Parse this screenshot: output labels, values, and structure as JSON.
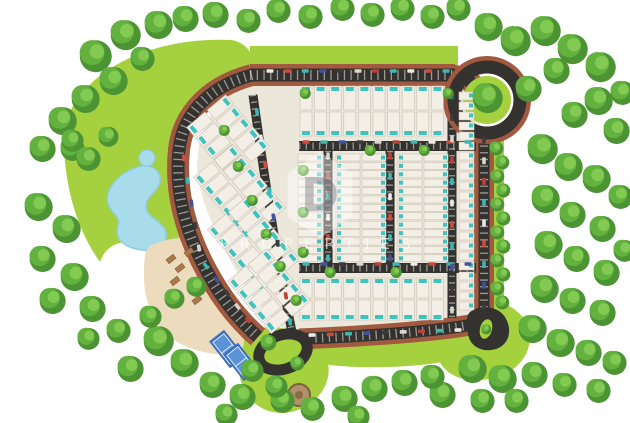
{
  "watermark": {
    "logo_letter": "D",
    "text": "PROPERTIES"
  },
  "palette": {
    "bg": "#ffffff",
    "lawn": "#a6d13e",
    "pad": "#ece7db",
    "sand": "#ecdcbd",
    "water": "#a9dcea",
    "waterEdge": "#90ccdd",
    "asphalt": "#34322e",
    "paver": "#a1593f",
    "tick": "rgba(255,255,255,0.5)",
    "house": "#f4efe6",
    "houseEdge": "#c8c0b2",
    "pool": "#3fc3bf",
    "treeBase": "#4c9333",
    "treeMid": "#63b13f",
    "treeHi": "#83ca52",
    "court": "#3a6fc2",
    "courtIn": "#5b93d8",
    "cabana": "#a97a4c",
    "gazebo": "#b2906a",
    "gazeboEdge": "#7c5f40",
    "cars": [
      "#eceae6",
      "#cf4b3b",
      "#3eb7b2",
      "#42549e",
      "#3b3b3b",
      "#d8d6d2",
      "#b8413a",
      "#3eb7b2"
    ]
  },
  "scene": {
    "lawns": [
      "M64,128 C78,72 150,36 232,40 C250,44 256,58 250,72 C212,84 192,108 184,142 C176,174 184,214 198,252 C186,260 166,256 150,248 C128,238 108,240 100,262 C78,232 62,184 64,128 Z",
      "M250,46 L458,46 L458,66 L250,66 Z",
      "M492,134 L504,134 L504,314 L492,314 Z",
      "M438,300 C468,292 504,298 520,314 C536,330 532,356 512,370 C490,384 458,384 444,368 C430,352 428,312 438,300 Z",
      "M298,336 C350,344 420,340 470,330 L470,356 C430,368 350,372 300,360 Z",
      "M248,330 C280,322 312,332 324,352 C336,374 324,400 298,410 C270,420 246,404 240,378 C236,358 238,338 248,330 Z"
    ],
    "pad": "M258,78 L452,78 C468,80 478,92 480,106 L480,316 C480,326 474,332 464,330 L302,338 C282,332 262,312 243,282 C222,248 204,212 198,178 C194,148 204,116 228,96 C238,87 248,80 258,78 Z",
    "lake": "M135,168 C150,162 162,170 160,182 C158,192 146,196 146,206 C146,218 162,220 166,232 C168,244 156,252 142,250 C124,248 114,238 118,226 C121,217 112,214 108,204 C104,190 118,174 135,168 Z",
    "pond": {
      "cx": 147,
      "cy": 158,
      "r": 8
    },
    "sand": "M150,246 C166,238 188,234 198,244 C210,260 224,288 236,314 C244,334 248,348 238,352 C220,358 194,352 174,340 C156,328 144,302 144,278 C144,260 144,252 150,246 Z",
    "roads": [
      {
        "d": "M250,75 L455,75",
        "w": 13,
        "paver": true,
        "ticks": true
      },
      {
        "d": "M452,75 C468,77 479,87 483,99",
        "w": 12,
        "paver": true,
        "ticks": false
      },
      {
        "d": "M484,132 L484,314",
        "w": 11,
        "paver": true,
        "ticks": true
      },
      {
        "d": "M470,325 C430,332 368,336 299,339",
        "w": 12,
        "paver": true,
        "ticks": true
      },
      {
        "d": "M252,75 C203,88 182,120 179,150 C175,188 184,226 202,262 C216,290 235,317 258,337",
        "w": 13,
        "paver": true,
        "ticks": true
      },
      {
        "d": "M253,95 C262,160 274,244 292,332",
        "w": 9,
        "paver": false,
        "ticks": true
      },
      {
        "d": "M299,146 L476,146",
        "w": 10,
        "paver": false,
        "ticks": true
      },
      {
        "d": "M299,268 L476,268",
        "w": 10,
        "paver": false,
        "ticks": true
      },
      {
        "d": "M328,151 L328,263",
        "w": 9,
        "paver": false,
        "ticks": true
      },
      {
        "d": "M390,151 L390,263",
        "w": 9,
        "paver": false,
        "ticks": true
      },
      {
        "d": "M452,88 L452,318",
        "w": 9,
        "paver": false,
        "ticks": true
      }
    ],
    "roundabout": {
      "cx": 487,
      "cy": 100,
      "rPaver": 40,
      "rRoad": 33,
      "rGreen": 24,
      "treeR": 15
    },
    "teardrop": {
      "d": "M470,312 C480,304 498,306 505,317 C513,330 509,345 496,349 C483,353 470,347 468,334 C467,326 465,317 470,312 Z",
      "island": {
        "cx": 486,
        "cy": 329,
        "rx": 6,
        "ry": 10,
        "rot": 15,
        "treeR": 5
      }
    },
    "loop": {
      "cx": 283,
      "cy": 352,
      "rx": 25,
      "ry": 17,
      "rot": -20,
      "w": 11,
      "islandRx": 13,
      "islandRy": 7
    },
    "bandsVertical": [
      {
        "x": 300,
        "y": 86,
        "n": 10,
        "pitch": 14.6,
        "w": 12,
        "h": 24,
        "pool": "top"
      },
      {
        "x": 300,
        "y": 112,
        "n": 10,
        "pitch": 14.6,
        "w": 12,
        "h": 24,
        "pool": "bottom"
      },
      {
        "x": 300,
        "y": 278,
        "n": 10,
        "pitch": 14.6,
        "w": 12,
        "h": 20,
        "pool": "top"
      },
      {
        "x": 300,
        "y": 300,
        "n": 10,
        "pitch": 14.6,
        "w": 12,
        "h": 20,
        "pool": "bottom"
      }
    ],
    "columnsHorizontal": [
      {
        "x": 298,
        "y": 154,
        "n": 13,
        "pitch": 8.4,
        "w": 24,
        "h": 7,
        "pool": "right"
      },
      {
        "x": 336,
        "y": 154,
        "n": 13,
        "pitch": 8.4,
        "w": 24,
        "h": 7,
        "pool": "left"
      },
      {
        "x": 362,
        "y": 154,
        "n": 13,
        "pitch": 8.4,
        "w": 24,
        "h": 7,
        "pool": "right"
      },
      {
        "x": 398,
        "y": 154,
        "n": 13,
        "pitch": 8.4,
        "w": 24,
        "h": 7,
        "pool": "left"
      },
      {
        "x": 424,
        "y": 154,
        "n": 13,
        "pitch": 8.4,
        "w": 24,
        "h": 7,
        "pool": "right"
      },
      {
        "x": 459,
        "y": 92,
        "n": 22,
        "pitch": 10,
        "w": 15,
        "h": 8,
        "pool": "right"
      }
    ],
    "angledStrips": [
      {
        "x": 205,
        "y": 112,
        "angle": 50,
        "n": 5,
        "pitch": 14,
        "w": 12,
        "h": 24,
        "rows": 2
      },
      {
        "x": 212,
        "y": 162,
        "angle": 50,
        "n": 6,
        "pitch": 14,
        "w": 12,
        "h": 24,
        "rows": 2
      },
      {
        "x": 226,
        "y": 214,
        "angle": 50,
        "n": 6,
        "pitch": 14,
        "w": 12,
        "h": 24,
        "rows": 2
      },
      {
        "x": 246,
        "y": 266,
        "angle": 50,
        "n": 5,
        "pitch": 14,
        "w": 12,
        "h": 24,
        "rows": 2
      }
    ],
    "carStrips": [
      [
        270,
        71,
        446,
        71,
        11
      ],
      [
        306,
        142,
        468,
        142,
        10
      ],
      [
        306,
        264,
        468,
        264,
        10
      ],
      [
        452,
        96,
        452,
        310,
        11
      ],
      [
        484,
        140,
        484,
        306,
        9
      ],
      [
        328,
        156,
        328,
        258,
        6
      ],
      [
        390,
        156,
        390,
        258,
        6
      ],
      [
        257,
        112,
        290,
        322,
        9
      ],
      [
        312,
        335,
        458,
        330,
        9
      ],
      [
        184,
        158,
        199,
        248,
        5
      ],
      [
        206,
        266,
        248,
        320,
        5
      ]
    ],
    "courts": [
      {
        "cx": 227,
        "cy": 349,
        "w": 19,
        "h": 34,
        "angle": -38
      },
      {
        "cx": 241,
        "cy": 362,
        "w": 19,
        "h": 34,
        "angle": -38
      }
    ],
    "cabanas": [
      [
        171,
        259
      ],
      [
        180,
        268
      ],
      [
        189,
        252
      ],
      [
        175,
        281
      ],
      [
        197,
        300
      ]
    ],
    "gazebo": {
      "cx": 299,
      "cy": 395,
      "r": 11
    },
    "trees": [
      [
        95,
        55,
        16
      ],
      [
        125,
        34,
        15
      ],
      [
        158,
        24,
        14
      ],
      [
        185,
        18,
        13
      ],
      [
        113,
        80,
        14
      ],
      [
        85,
        98,
        14
      ],
      [
        142,
        58,
        12
      ],
      [
        62,
        120,
        14
      ],
      [
        42,
        148,
        13
      ],
      [
        72,
        148,
        12
      ],
      [
        215,
        14,
        13
      ],
      [
        248,
        20,
        12
      ],
      [
        278,
        10,
        12
      ],
      [
        310,
        16,
        12
      ],
      [
        342,
        8,
        12
      ],
      [
        372,
        14,
        12
      ],
      [
        402,
        8,
        12
      ],
      [
        432,
        16,
        12
      ],
      [
        458,
        8,
        12
      ],
      [
        488,
        26,
        14
      ],
      [
        515,
        40,
        15
      ],
      [
        545,
        30,
        15
      ],
      [
        572,
        48,
        15
      ],
      [
        600,
        66,
        15
      ],
      [
        556,
        70,
        13
      ],
      [
        528,
        88,
        13
      ],
      [
        598,
        100,
        14
      ],
      [
        574,
        114,
        13
      ],
      [
        616,
        130,
        13
      ],
      [
        622,
        92,
        12
      ],
      [
        542,
        148,
        15
      ],
      [
        568,
        166,
        14
      ],
      [
        596,
        178,
        14
      ],
      [
        620,
        196,
        12
      ],
      [
        545,
        198,
        14
      ],
      [
        572,
        214,
        13
      ],
      [
        602,
        228,
        13
      ],
      [
        548,
        244,
        14
      ],
      [
        576,
        258,
        13
      ],
      [
        606,
        272,
        13
      ],
      [
        544,
        288,
        14
      ],
      [
        572,
        300,
        13
      ],
      [
        602,
        312,
        13
      ],
      [
        624,
        250,
        11
      ],
      [
        532,
        328,
        14
      ],
      [
        560,
        342,
        14
      ],
      [
        588,
        352,
        13
      ],
      [
        614,
        362,
        12
      ],
      [
        472,
        368,
        14
      ],
      [
        502,
        378,
        14
      ],
      [
        534,
        374,
        13
      ],
      [
        564,
        384,
        12
      ],
      [
        442,
        394,
        13
      ],
      [
        482,
        400,
        12
      ],
      [
        516,
        400,
        12
      ],
      [
        598,
        390,
        12
      ],
      [
        344,
        398,
        13
      ],
      [
        374,
        388,
        13
      ],
      [
        404,
        382,
        13
      ],
      [
        312,
        408,
        12
      ],
      [
        282,
        400,
        12
      ],
      [
        432,
        376,
        12
      ],
      [
        358,
        416,
        11
      ],
      [
        158,
        340,
        15
      ],
      [
        184,
        362,
        14
      ],
      [
        212,
        384,
        13
      ],
      [
        242,
        396,
        13
      ],
      [
        130,
        368,
        13
      ],
      [
        252,
        370,
        11
      ],
      [
        276,
        386,
        11
      ],
      [
        226,
        414,
        11
      ],
      [
        38,
        206,
        14
      ],
      [
        66,
        228,
        14
      ],
      [
        42,
        258,
        13
      ],
      [
        74,
        276,
        14
      ],
      [
        52,
        300,
        13
      ],
      [
        92,
        308,
        13
      ],
      [
        118,
        330,
        12
      ],
      [
        88,
        338,
        11
      ],
      [
        88,
        158,
        12
      ],
      [
        72,
        140,
        11
      ],
      [
        108,
        136,
        10
      ],
      [
        196,
        286,
        10
      ],
      [
        174,
        298,
        10
      ],
      [
        150,
        316,
        11
      ],
      [
        268,
        342,
        8
      ],
      [
        297,
        363,
        7
      ]
    ],
    "hedgeTrees": [
      [
        496,
        148
      ],
      [
        502,
        162
      ],
      [
        497,
        176
      ],
      [
        503,
        190
      ],
      [
        497,
        204
      ],
      [
        503,
        218
      ],
      [
        497,
        232
      ],
      [
        503,
        246
      ],
      [
        497,
        260
      ],
      [
        503,
        274
      ],
      [
        497,
        288
      ],
      [
        502,
        302
      ]
    ],
    "innerTrees": [
      [
        224,
        130
      ],
      [
        238,
        166
      ],
      [
        252,
        200
      ],
      [
        266,
        234
      ],
      [
        280,
        266
      ],
      [
        296,
        300
      ],
      [
        305,
        93
      ],
      [
        448,
        93
      ],
      [
        370,
        150
      ],
      [
        424,
        150
      ],
      [
        330,
        272
      ],
      [
        396,
        272
      ],
      [
        303,
        170
      ],
      [
        303,
        212
      ],
      [
        303,
        252
      ]
    ]
  }
}
